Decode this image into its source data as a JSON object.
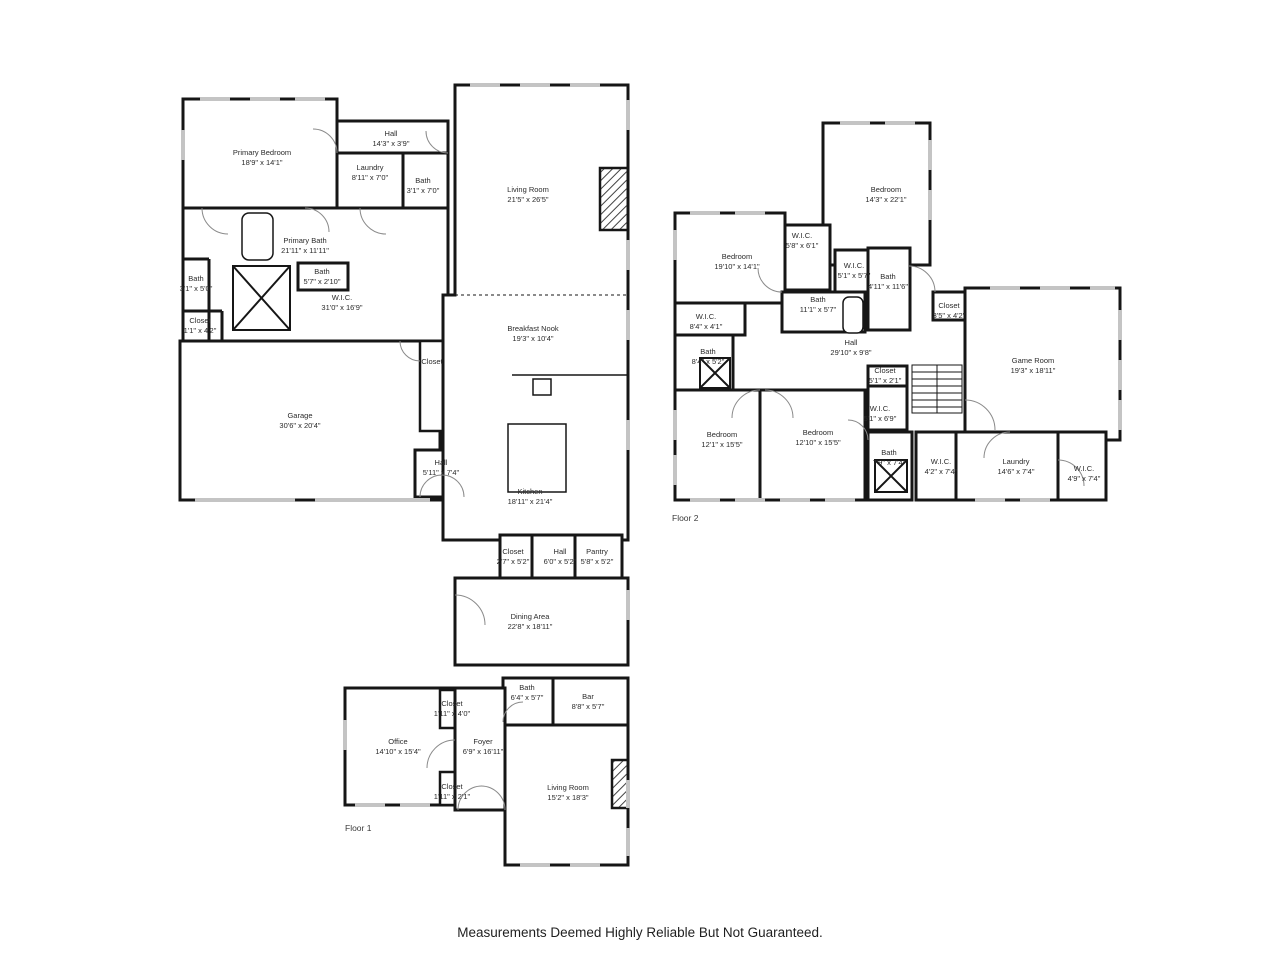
{
  "caption": "Measurements Deemed Highly Reliable But Not Guaranteed.",
  "floor1": {
    "label": "Floor 1",
    "rooms": [
      {
        "name": "Primary Bedroom",
        "dims": "18'9\" x 14'1\"",
        "x": 262,
        "y": 158
      },
      {
        "name": "Hall",
        "dims": "14'3\" x 3'9\"",
        "x": 391,
        "y": 139
      },
      {
        "name": "Laundry",
        "dims": "8'11\" x 7'0\"",
        "x": 370,
        "y": 173
      },
      {
        "name": "Bath",
        "dims": "3'1\" x 7'0\"",
        "x": 423,
        "y": 186
      },
      {
        "name": "Primary Bath",
        "dims": "21'11\" x 11'11\"",
        "x": 305,
        "y": 246
      },
      {
        "name": "Bath",
        "dims": "3'1\" x 5'0\"",
        "x": 196,
        "y": 284
      },
      {
        "name": "Bath",
        "dims": "5'7\" x 2'10\"",
        "x": 322,
        "y": 277
      },
      {
        "name": "W.I.C.",
        "dims": "31'0\" x 16'9\"",
        "x": 342,
        "y": 303
      },
      {
        "name": "Closet",
        "dims": "1'1\" x 4'2\"",
        "x": 200,
        "y": 326
      },
      {
        "name": "Garage",
        "dims": "30'6\" x 20'4\"",
        "x": 300,
        "y": 421
      },
      {
        "name": "Closet",
        "dims": "",
        "x": 432,
        "y": 362
      },
      {
        "name": "Hall",
        "dims": "5'11\" x 7'4\"",
        "x": 441,
        "y": 468
      },
      {
        "name": "Living Room",
        "dims": "21'5\" x 26'5\"",
        "x": 528,
        "y": 195
      },
      {
        "name": "Breakfast Nook",
        "dims": "19'3\" x 10'4\"",
        "x": 533,
        "y": 334
      },
      {
        "name": "Kitchen",
        "dims": "18'11\" x 21'4\"",
        "x": 530,
        "y": 497
      },
      {
        "name": "Closet",
        "dims": "2'7\" x 5'2\"",
        "x": 513,
        "y": 557
      },
      {
        "name": "Hall",
        "dims": "6'0\" x 5'2\"",
        "x": 560,
        "y": 557
      },
      {
        "name": "Pantry",
        "dims": "5'8\" x 5'2\"",
        "x": 597,
        "y": 557
      },
      {
        "name": "Dining Area",
        "dims": "22'8\" x 18'11\"",
        "x": 530,
        "y": 622
      },
      {
        "name": "Bath",
        "dims": "6'4\" x 5'7\"",
        "x": 527,
        "y": 693
      },
      {
        "name": "Bar",
        "dims": "8'8\" x 5'7\"",
        "x": 588,
        "y": 702
      },
      {
        "name": "Closet",
        "dims": "1'11\" x 4'0\"",
        "x": 452,
        "y": 709
      },
      {
        "name": "Office",
        "dims": "14'10\" x 15'4\"",
        "x": 398,
        "y": 747
      },
      {
        "name": "Foyer",
        "dims": "6'9\" x 16'11\"",
        "x": 483,
        "y": 747
      },
      {
        "name": "Closet",
        "dims": "1'11\" x 2'1\"",
        "x": 452,
        "y": 792
      },
      {
        "name": "Living Room",
        "dims": "15'2\" x 18'3\"",
        "x": 568,
        "y": 793
      }
    ],
    "label_x": 345,
    "label_y": 826
  },
  "floor2": {
    "label": "Floor 2",
    "rooms": [
      {
        "name": "Bedroom",
        "dims": "14'3\" x 22'1\"",
        "x": 886,
        "y": 195
      },
      {
        "name": "Bedroom",
        "dims": "19'10\" x 14'1\"",
        "x": 737,
        "y": 262
      },
      {
        "name": "W.I.C.",
        "dims": "5'8\" x 6'1\"",
        "x": 802,
        "y": 241
      },
      {
        "name": "W.I.C.",
        "dims": "5'1\" x 5'7\"",
        "x": 854,
        "y": 271
      },
      {
        "name": "Bath",
        "dims": "4'11\" x 11'6\"",
        "x": 888,
        "y": 282
      },
      {
        "name": "Bath",
        "dims": "11'1\" x 5'7\"",
        "x": 818,
        "y": 305
      },
      {
        "name": "Closet",
        "dims": "3'5\" x 4'2\"",
        "x": 949,
        "y": 311
      },
      {
        "name": "W.I.C.",
        "dims": "8'4\" x 4'1\"",
        "x": 706,
        "y": 322
      },
      {
        "name": "Hall",
        "dims": "29'10\" x 9'8\"",
        "x": 851,
        "y": 348
      },
      {
        "name": "Bath",
        "dims": "8'4\" x 5'2\"",
        "x": 708,
        "y": 357
      },
      {
        "name": "Game Room",
        "dims": "19'3\" x 18'11\"",
        "x": 1033,
        "y": 366
      },
      {
        "name": "Closet",
        "dims": "5'1\" x 2'1\"",
        "x": 885,
        "y": 376
      },
      {
        "name": "W.I.C.",
        "dims": "5'1\" x 6'9\"",
        "x": 880,
        "y": 414
      },
      {
        "name": "Bedroom",
        "dims": "12'1\" x 15'5\"",
        "x": 722,
        "y": 440
      },
      {
        "name": "Bedroom",
        "dims": "12'10\" x 15'5\"",
        "x": 818,
        "y": 438
      },
      {
        "name": "Bath",
        "dims": "7'9\" x 7'4\"",
        "x": 889,
        "y": 458
      },
      {
        "name": "W.I.C.",
        "dims": "4'2\" x 7'4\"",
        "x": 941,
        "y": 467
      },
      {
        "name": "Laundry",
        "dims": "14'6\" x 7'4\"",
        "x": 1016,
        "y": 467
      },
      {
        "name": "W.I.C.",
        "dims": "4'9\" x 7'4\"",
        "x": 1084,
        "y": 474
      }
    ],
    "label_x": 672,
    "label_y": 516
  }
}
